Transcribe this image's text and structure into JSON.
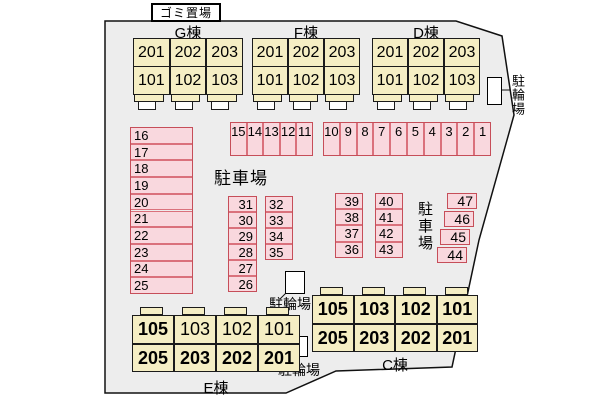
{
  "labels": {
    "garbage": "ゴミ置場",
    "parking_left": "駐車場",
    "parking_right": "駐車場"
  },
  "buildings": {
    "top": [
      {
        "name": "G棟",
        "rooms_upper": [
          "201",
          "202",
          "203"
        ],
        "rooms_lower": [
          "101",
          "102",
          "103"
        ]
      },
      {
        "name": "F棟",
        "rooms_upper": [
          "201",
          "202",
          "203"
        ],
        "rooms_lower": [
          "101",
          "102",
          "103"
        ]
      },
      {
        "name": "D棟",
        "rooms_upper": [
          "201",
          "202",
          "203"
        ],
        "rooms_lower": [
          "101",
          "102",
          "103"
        ]
      }
    ],
    "bottom": [
      {
        "name": "E棟",
        "rooms_upper": [
          "105",
          "103",
          "102",
          "101"
        ],
        "rooms_lower": [
          "205",
          "203",
          "202",
          "201"
        ],
        "bold_upper": [
          true,
          false,
          false,
          false
        ],
        "bold_lower": [
          true,
          true,
          true,
          true
        ]
      },
      {
        "name": "C棟",
        "rooms_upper": [
          "105",
          "103",
          "102",
          "101"
        ],
        "rooms_lower": [
          "205",
          "203",
          "202",
          "201"
        ],
        "bold_upper": [
          true,
          true,
          true,
          true
        ],
        "bold_lower": [
          true,
          true,
          true,
          true
        ]
      }
    ]
  },
  "parking_spaces": {
    "left_column": [
      "16",
      "17",
      "18",
      "19",
      "20",
      "21",
      "22",
      "23",
      "24",
      "25"
    ],
    "strip_west": [
      "15",
      "14",
      "13",
      "12",
      "11"
    ],
    "strip_east": [
      "10",
      "9",
      "8",
      "7",
      "6",
      "5",
      "4",
      "3",
      "2",
      "1"
    ],
    "mid_col_a": [
      "31",
      "30",
      "29",
      "28",
      "27",
      "26"
    ],
    "mid_col_b": [
      "32",
      "33",
      "34",
      "35"
    ],
    "east_col_a": [
      "39",
      "38",
      "37",
      "36"
    ],
    "east_col_b": [
      "40",
      "41",
      "42",
      "43"
    ],
    "edge_col": [
      "47",
      "46",
      "45",
      "44"
    ]
  },
  "bicycle_areas": [
    {
      "label": "駐輪場"
    },
    {
      "label": "駐輪場"
    },
    {
      "label": "駐輪場"
    }
  ],
  "colors": {
    "site_fill": "#ededed",
    "building_fill": "#f5eec4",
    "parking_fill": "#f9d8de",
    "parking_border": "#da717c",
    "parking_border_strong": "#c64e59",
    "line": "#111111"
  }
}
